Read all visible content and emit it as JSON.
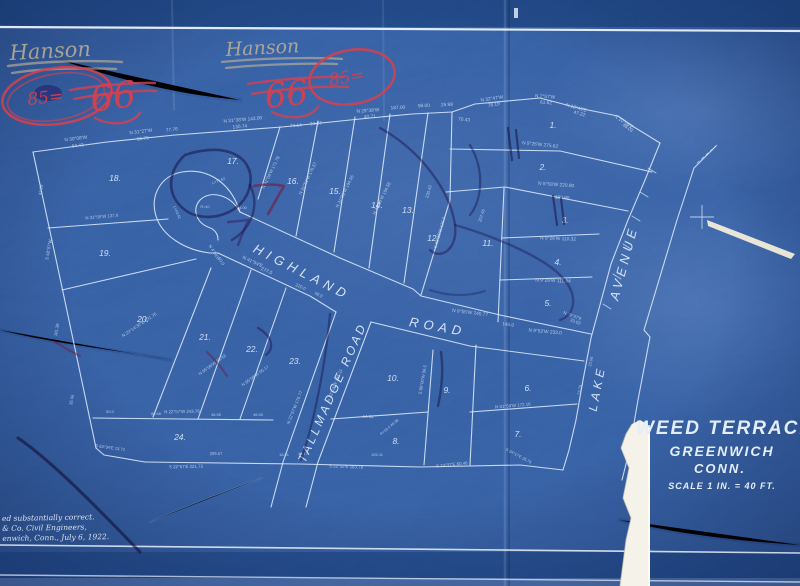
{
  "map": {
    "colors": {
      "paper_blue": "#16499a",
      "line_ink": "#dce9fa",
      "bearing_ink": "#c9dcf4",
      "red_crayon": "#d8404e",
      "pencil": "#c8b793",
      "tear_white": "#f5f2e9"
    },
    "title_block": {
      "line1": "WEED TERRACE",
      "line2": "GREENWICH",
      "line3": "CONN.",
      "line4": "SCALE 1 IN. = 40 FT."
    },
    "certification": {
      "line1": "ed substantially correct.",
      "line2": "& Co. Civil Engineers,",
      "line3": "enwich, Conn., July 6, 1922."
    },
    "roads": [
      {
        "label": "HIGHLAND",
        "x": 300,
        "y": 276,
        "r": 27,
        "ls": 5,
        "s": 13
      },
      {
        "label": "ROAD",
        "x": 437,
        "y": 331,
        "r": 10,
        "ls": 5,
        "s": 13
      },
      {
        "label": "TALLMADGE ROAD",
        "x": 336,
        "y": 394,
        "r": -66,
        "ls": 3,
        "s": 12
      },
      {
        "label": "AVENUE",
        "x": 628,
        "y": 264,
        "r": -75,
        "ls": 4,
        "s": 13
      },
      {
        "label": "LAKE",
        "x": 601,
        "y": 389,
        "r": -79,
        "ls": 4,
        "s": 12
      }
    ],
    "lots": [
      {
        "t": "1.",
        "x": 553,
        "y": 128
      },
      {
        "t": "2.",
        "x": 543,
        "y": 170
      },
      {
        "t": "3.",
        "x": 565,
        "y": 223
      },
      {
        "t": "4.",
        "x": 558,
        "y": 265
      },
      {
        "t": "5.",
        "x": 548,
        "y": 306
      },
      {
        "t": "6.",
        "x": 528,
        "y": 391
      },
      {
        "t": "7.",
        "x": 518,
        "y": 437
      },
      {
        "t": "8.",
        "x": 396,
        "y": 444
      },
      {
        "t": "9.",
        "x": 447,
        "y": 393
      },
      {
        "t": "10.",
        "x": 393,
        "y": 381
      },
      {
        "t": "11.",
        "x": 488,
        "y": 246
      },
      {
        "t": "12.",
        "x": 433,
        "y": 241
      },
      {
        "t": "13.",
        "x": 408,
        "y": 213
      },
      {
        "t": "14.",
        "x": 377,
        "y": 208
      },
      {
        "t": "15.",
        "x": 335,
        "y": 194
      },
      {
        "t": "16.",
        "x": 293,
        "y": 184
      },
      {
        "t": "17.",
        "x": 233,
        "y": 164
      },
      {
        "t": "18.",
        "x": 115,
        "y": 181
      },
      {
        "t": "19.",
        "x": 105,
        "y": 256
      },
      {
        "t": "20.",
        "x": 143,
        "y": 322
      },
      {
        "t": "21.",
        "x": 205,
        "y": 340
      },
      {
        "t": "22.",
        "x": 252,
        "y": 352
      },
      {
        "t": "23.",
        "x": 295,
        "y": 364
      },
      {
        "t": "24.",
        "x": 180,
        "y": 440
      }
    ],
    "bearings": [
      {
        "t": "N 30°08'W",
        "x": 76,
        "y": 140,
        "r": -7
      },
      {
        "t": "94.43",
        "x": 78,
        "y": 147,
        "r": -7
      },
      {
        "t": "N 31°27'W",
        "x": 141,
        "y": 133,
        "r": -7
      },
      {
        "t": "96.79",
        "x": 143,
        "y": 140,
        "r": -7
      },
      {
        "t": "77.76",
        "x": 172,
        "y": 131,
        "r": -6
      },
      {
        "t": "N 31°38'W 143.00",
        "x": 243,
        "y": 121,
        "r": -5
      },
      {
        "t": "130.74",
        "x": 240,
        "y": 128,
        "r": -5
      },
      {
        "t": "74.14",
        "x": 296,
        "y": 127,
        "r": -4
      },
      {
        "t": "34.07",
        "x": 316,
        "y": 125,
        "r": -4
      },
      {
        "t": "N 29°38'W",
        "x": 368,
        "y": 112,
        "r": -4
      },
      {
        "t": "40.71",
        "x": 370,
        "y": 118,
        "r": -4
      },
      {
        "t": "187.00",
        "x": 398,
        "y": 109,
        "r": -3
      },
      {
        "t": "98.00",
        "x": 424,
        "y": 107,
        "r": -3
      },
      {
        "t": "29.98",
        "x": 447,
        "y": 106,
        "r": -3
      },
      {
        "t": "70.43",
        "x": 464,
        "y": 121,
        "r": 5
      },
      {
        "t": "N 32°47'W",
        "x": 492,
        "y": 100,
        "r": -8
      },
      {
        "t": "78.19",
        "x": 494,
        "y": 106,
        "r": -8
      },
      {
        "t": "N 7°57'W",
        "x": 545,
        "y": 98,
        "r": 4
      },
      {
        "t": "61.62",
        "x": 546,
        "y": 104,
        "r": 4
      },
      {
        "t": "N 12°43'E",
        "x": 576,
        "y": 109,
        "r": 16
      },
      {
        "t": "47.22",
        "x": 579,
        "y": 115,
        "r": 16
      },
      {
        "t": "N 10°09'E",
        "x": 623,
        "y": 123,
        "r": 33
      },
      {
        "t": "48.02",
        "x": 627,
        "y": 129,
        "r": 33
      },
      {
        "t": "N 9°26'W  275.62",
        "x": 540,
        "y": 146,
        "r": 6
      },
      {
        "t": "N 5°58'W  220.90",
        "x": 556,
        "y": 186,
        "r": 4
      },
      {
        "t": "120.90",
        "x": 562,
        "y": 199,
        "r": 4
      },
      {
        "t": "N 9°26'W  110.32",
        "x": 558,
        "y": 240,
        "r": 2
      },
      {
        "t": "N 9°26'W  111.84",
        "x": 553,
        "y": 282,
        "r": 2
      },
      {
        "t": "N 9°55'W  245.77",
        "x": 470,
        "y": 314,
        "r": 7
      },
      {
        "t": "140.0",
        "x": 508,
        "y": 326,
        "r": 7
      },
      {
        "t": "N 79°37'E",
        "x": 572,
        "y": 317,
        "r": 20,
        "s": 4.3
      },
      {
        "t": "33.03",
        "x": 575,
        "y": 323,
        "r": 20,
        "s": 4.3
      },
      {
        "t": "N 9°52'W  233.0",
        "x": 545,
        "y": 333,
        "r": 5
      },
      {
        "t": "N 41°54'E",
        "x": 252,
        "y": 263,
        "r": 25
      },
      {
        "t": "277.0",
        "x": 266,
        "y": 272,
        "r": 25
      },
      {
        "t": "220.0",
        "x": 300,
        "y": 288,
        "r": 25,
        "s": 4.3
      },
      {
        "t": "50.0",
        "x": 318,
        "y": 296,
        "r": 25,
        "s": 4.3
      },
      {
        "t": "N 4°54'E",
        "x": 213,
        "y": 253,
        "r": 58,
        "s": 4.3
      },
      {
        "t": "50.0",
        "x": 220,
        "y": 262,
        "r": 58,
        "s": 4.3
      },
      {
        "t": "64.64",
        "x": 368,
        "y": 418,
        "r": 3,
        "s": 4.3
      },
      {
        "t": "R=16.0  49.38",
        "x": 390,
        "y": 428,
        "r": -40,
        "s": 3.8
      },
      {
        "t": "N 81°58'W  172.16",
        "x": 513,
        "y": 407,
        "r": -5,
        "s": 4.4
      },
      {
        "t": "S 80°00'W  96.5",
        "x": 424,
        "y": 380,
        "r": -80,
        "s": 4.3
      },
      {
        "t": "N 22°52'W  145.11",
        "x": 336,
        "y": 386,
        "r": -68,
        "s": 4.4
      },
      {
        "t": "N 22°57'W  176.77",
        "x": 296,
        "y": 408,
        "r": -68,
        "s": 4.4
      },
      {
        "t": "N 65°06'W  95.43",
        "x": 213,
        "y": 366,
        "r": -36,
        "s": 4.3
      },
      {
        "t": "N 65°06'W  95.17",
        "x": 256,
        "y": 377,
        "r": -36,
        "s": 4.3
      },
      {
        "t": "N 23°14'30\"E  231.76",
        "x": 140,
        "y": 326,
        "r": -34,
        "s": 4.4
      },
      {
        "t": "S 48°07'W",
        "x": 50,
        "y": 250,
        "r": -80,
        "s": 4.4
      },
      {
        "t": "43.28",
        "x": 42,
        "y": 190,
        "r": -80,
        "s": 4.2
      },
      {
        "t": "181.38",
        "x": 58,
        "y": 330,
        "r": -80,
        "s": 4.2
      },
      {
        "t": "35.06",
        "x": 73,
        "y": 400,
        "r": -80,
        "s": 4.2
      },
      {
        "t": "N 31°55'W  137.6",
        "x": 102,
        "y": 218,
        "r": -5,
        "s": 4.4
      },
      {
        "t": "N 22°57'W  243.76",
        "x": 182,
        "y": 413,
        "r": -1,
        "s": 4.4
      },
      {
        "t": "50.0",
        "x": 110,
        "y": 413,
        "r": 0,
        "s": 4
      },
      {
        "t": "80.66",
        "x": 156,
        "y": 415,
        "r": 0,
        "s": 4
      },
      {
        "t": "46.55",
        "x": 216,
        "y": 416,
        "r": 0,
        "s": 4
      },
      {
        "t": "46.55",
        "x": 258,
        "y": 416,
        "r": 0,
        "s": 4
      },
      {
        "t": "209.57",
        "x": 216,
        "y": 455,
        "r": -1,
        "s": 4.2
      },
      {
        "t": "S 22°57'E  221.73",
        "x": 186,
        "y": 468,
        "r": -1,
        "s": 4.4
      },
      {
        "t": "18.91",
        "x": 284,
        "y": 456,
        "r": 0,
        "s": 4
      },
      {
        "t": "44.17",
        "x": 303,
        "y": 455,
        "r": 0,
        "s": 4
      },
      {
        "t": "S 22°32'E  183.78",
        "x": 346,
        "y": 468,
        "r": 2,
        "s": 4.4
      },
      {
        "t": "105.11",
        "x": 377,
        "y": 456,
        "r": 0,
        "s": 4
      },
      {
        "t": "S 74°37'E  60.48",
        "x": 452,
        "y": 466,
        "r": -6,
        "s": 4.4
      },
      {
        "t": "S 24°17'E  25.76",
        "x": 518,
        "y": 457,
        "r": 28,
        "s": 4
      },
      {
        "t": "S 63°34'E  13.71",
        "x": 110,
        "y": 449,
        "r": 8,
        "s": 4.2
      },
      {
        "t": "207.45",
        "x": 483,
        "y": 216,
        "r": -72,
        "s": 4.3
      },
      {
        "t": "230.43",
        "x": 430,
        "y": 192,
        "r": -74,
        "s": 4.3
      },
      {
        "t": "S 30°35'W  126.0",
        "x": 441,
        "y": 233,
        "r": -74,
        "s": 4.3
      },
      {
        "t": "N 31°06'W  171.78",
        "x": 272,
        "y": 173,
        "r": -64,
        "s": 4.4
      },
      {
        "t": "N 31°51'W  176.57",
        "x": 309,
        "y": 179,
        "r": -64,
        "s": 4.4
      },
      {
        "t": "N 31°05'W  194.56",
        "x": 346,
        "y": 192,
        "r": -64,
        "s": 4.4
      },
      {
        "t": "N 31°09'W  194.55",
        "x": 383,
        "y": 199,
        "r": -64,
        "s": 4.4
      },
      {
        "t": "L=77.52",
        "x": 219,
        "y": 182,
        "r": -20,
        "s": 3.8
      },
      {
        "t": "L=43.41",
        "x": 176,
        "y": 213,
        "r": 65,
        "s": 3.8
      },
      {
        "t": "R=40",
        "x": 205,
        "y": 208,
        "r": 0,
        "s": 3.8
      },
      {
        "t": "4.00",
        "x": 243,
        "y": 209,
        "r": 0,
        "s": 3.8
      },
      {
        "t": "23.06",
        "x": 592,
        "y": 362,
        "r": -78,
        "s": 4
      },
      {
        "t": "73.76",
        "x": 581,
        "y": 390,
        "r": -80,
        "s": 4
      }
    ]
  },
  "annotations": {
    "left": {
      "name": "Hanson",
      "score": "66",
      "circled": "85="
    },
    "right": {
      "name": "Hanson",
      "score": "66",
      "circled": "85="
    }
  }
}
